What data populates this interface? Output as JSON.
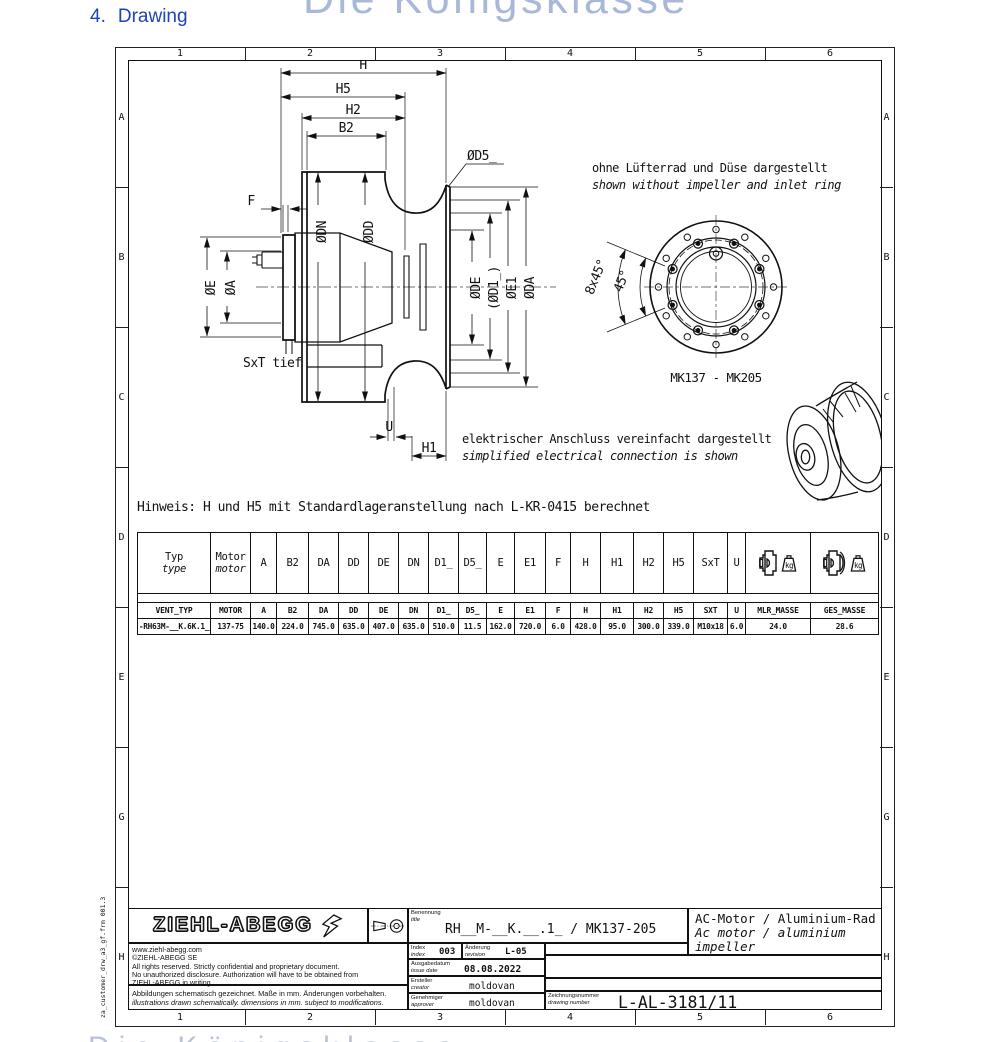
{
  "page": {
    "heading_number": "4.",
    "heading_text": "Drawing",
    "watermark": "Die Königsklasse"
  },
  "frame": {
    "columns": [
      "1",
      "2",
      "3",
      "4",
      "5",
      "6"
    ],
    "rows": [
      "A",
      "B",
      "C",
      "D",
      "E",
      "G",
      "H"
    ],
    "form_ref": "za_customer_drw_a3_gf.frm 001.3"
  },
  "drawing": {
    "note_impeller_de": "ohne Lüfterrad und Düse dargestellt",
    "note_impeller_en": "shown without impeller and inlet ring",
    "note_electrical_de": "elektrischer Anschluss vereinfacht dargestellt",
    "note_electrical_en": "simplified electrical connection is shown",
    "hint": "Hinweis: H und H5 mit Standardlageranstellung nach L-KR-0415 berechnet",
    "front_view_caption": "MK137 - MK205",
    "dims": {
      "h": "H",
      "h5": "H5",
      "h2": "H2",
      "b2": "B2",
      "d5": "ØD5_",
      "f": "F",
      "dn": "ØDN",
      "dd": "ØDD",
      "e": "ØE",
      "a": "ØA",
      "de": "ØDE",
      "d1": "(ØD1_)",
      "e1": "ØE1",
      "da": "ØDA",
      "sxt": "SxT tief",
      "u": "U",
      "h1": "H1",
      "angle8x45": "8x45°",
      "angle45": "45°"
    }
  },
  "table": {
    "header": {
      "typ_de": "Typ",
      "typ_en": "type",
      "motor_de": "Motor",
      "motor_en": "motor",
      "cols": [
        "A",
        "B2",
        "DA",
        "DD",
        "DE",
        "DN",
        "D1_",
        "D5_",
        "E",
        "E1",
        "F",
        "H",
        "H1",
        "H2",
        "H5",
        "SxT",
        "U"
      ],
      "kg": "kg"
    },
    "db": [
      "VENT_TYP",
      "MOTOR",
      "A",
      "B2",
      "DA",
      "DD",
      "DE",
      "DN",
      "D1_",
      "D5_",
      "E",
      "E1",
      "F",
      "H",
      "H1",
      "H2",
      "H5",
      "SXT",
      "U",
      "MLR_MASSE",
      "GES_MASSE"
    ],
    "data": [
      "-RH63M-__K.6K.1_",
      "137-75",
      "140.0",
      "224.0",
      "745.0",
      "635.0",
      "407.0",
      "635.0",
      "510.0",
      "11.5",
      "162.0",
      "720.0",
      "6.0",
      "428.0",
      "95.0",
      "300.0",
      "339.0",
      "M10x18",
      "6.0",
      "24.0",
      "28.6"
    ]
  },
  "titleblock": {
    "logo": "ZIEHL-ABEGG",
    "website": "www.ziehl-abegg.com",
    "company": "©ZIEHL-ABEGG SE",
    "rights1": "All rights reserved. Strictly confidential and proprietary document.",
    "rights2": "No unauthorized disclosure. Authorization will have to be obtained from",
    "rights3": "ZIEHL-ABEGG in writing.",
    "note_de": "Abbildungen schematisch gezeichnet. Maße in mm. Änderungen vorbehalten.",
    "note_en": "illustrations drawn schematically. dimensions in mm. subject to modifications.",
    "benennung_de": "Benennung",
    "benennung_en": "title",
    "title_value": "RH__M-__K.__.1_ / MK137-205",
    "product_de": "AC-Motor / Aluminium-Rad",
    "product_en": "Ac motor / aluminium impeller",
    "index_de": "Index",
    "index_en": "index",
    "index_value": "003",
    "rev_de": "Änderung",
    "rev_en": "revision",
    "rev_value": "L-05",
    "date_de": "Ausgabedatum",
    "date_en": "issue date",
    "date_value": "08.08.2022",
    "creator_de": "Ersteller",
    "creator_en": "creator",
    "creator_value": "moldovan",
    "approver_de": "Genehmiger",
    "approver_en": "approver",
    "approver_value": "moldovan",
    "dno_de": "Zeichnungsnummer",
    "dno_en": "drawing number",
    "dno_value": "L-AL-3181/11"
  }
}
